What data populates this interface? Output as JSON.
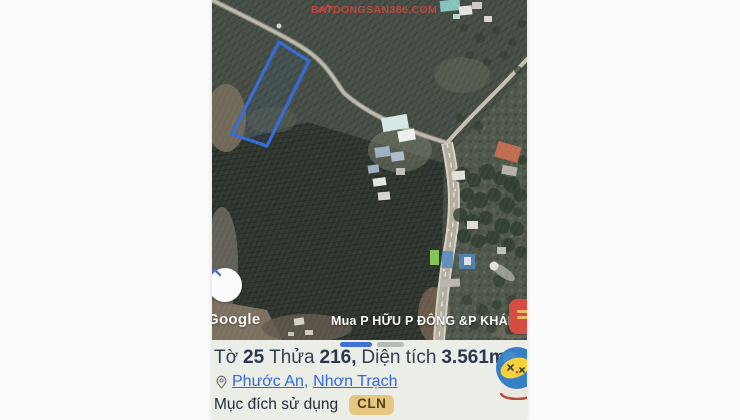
{
  "watermark": {
    "text": "BATDONGSAN386.COM"
  },
  "map": {
    "google_logo": "Google",
    "caption": "Mua P HỮU P ĐÔNG &P KHÁNH",
    "parcel_outline_color": "#2e6be0"
  },
  "carousel": {
    "count": 2,
    "active_index": 0,
    "active_color": "#3b6fe0",
    "inactive_color": "#b9bdb9"
  },
  "panel": {
    "title": {
      "label_sheet": "Tờ",
      "sheet_number": "25",
      "label_parcel": "Thửa",
      "parcel_number": "216,",
      "label_area": "Diện tích",
      "area_value": "3.561m²"
    },
    "location": {
      "ward": "Phước An",
      "separator": ",",
      "district": "Nhơn Trạch"
    },
    "land_use": {
      "label": "Mục đích sử dụng",
      "code": "CLN"
    },
    "colors": {
      "badge_bg": "#edc87d",
      "badge_text": "#533d0c",
      "link_blue": "#2f66e8",
      "title_text": "#303d52",
      "panel_bg": "#eef1ea"
    }
  }
}
